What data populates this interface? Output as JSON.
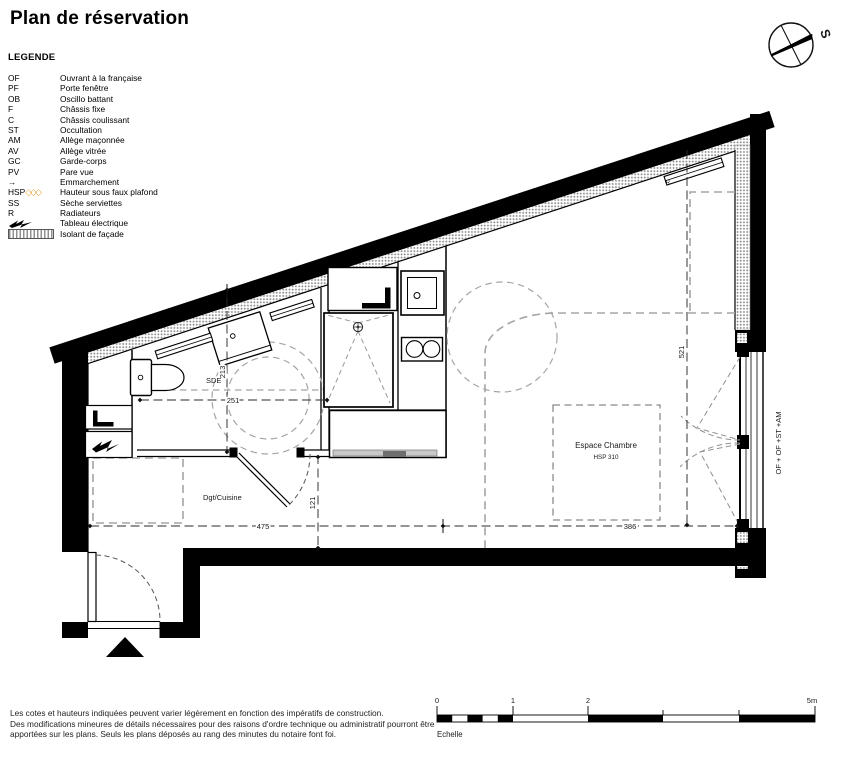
{
  "title": "Plan de réservation",
  "legend": {
    "heading": "LEGENDE",
    "hsp_diamonds": "◇◇◇",
    "items": [
      {
        "abbr": "OF",
        "label": "Ouvrant à la française"
      },
      {
        "abbr": "PF",
        "label": "Porte fenêtre"
      },
      {
        "abbr": "OB",
        "label": "Oscillo battant"
      },
      {
        "abbr": "F",
        "label": "Châssis fixe"
      },
      {
        "abbr": "C",
        "label": "Châssis coulissant"
      },
      {
        "abbr": "ST",
        "label": "Occultation"
      },
      {
        "abbr": "AM",
        "label": "Allège maçonnée"
      },
      {
        "abbr": "AV",
        "label": "Allège vitrée"
      },
      {
        "abbr": "GC",
        "label": "Garde-corps"
      },
      {
        "abbr": "PV",
        "label": "Pare vue"
      },
      {
        "abbr": "→",
        "label": "Emmarchement"
      },
      {
        "abbr": "HSP",
        "label": "Hauteur sous faux plafond"
      },
      {
        "abbr": "SS",
        "label": "Sèche serviettes"
      },
      {
        "abbr": "R",
        "label": "Radiateurs"
      },
      {
        "abbr": "",
        "label": "Tableau électrique"
      },
      {
        "abbr": "",
        "label": "Isolant de façade"
      }
    ]
  },
  "plan": {
    "labels": {
      "sde": "SDE",
      "dgt_cuisine": "Dgt/Cuisine",
      "chambre": "Espace Chambre",
      "chambre_hsp": "HSP 310",
      "radiator": "R",
      "window": "OF + OF +ST +AM"
    },
    "dimensions": {
      "bath_height": "213",
      "bath_width": "251",
      "room_height": "521",
      "passage": "121",
      "left_width": "475",
      "right_width": "386"
    }
  },
  "compass": {
    "south": "S"
  },
  "scale": {
    "ticks": [
      "0",
      "1",
      "2",
      "5m"
    ],
    "caption": "Echelle"
  },
  "footer": {
    "lines": [
      "Les cotes et hauteurs indiquées peuvent varier légèrement en fonction des impératifs de construction.",
      "Des modifications mineures de détails nécessaires pour des raisons d'ordre technique ou administratif pourront être",
      "apportées sur les plans. Seuls les plans déposés au rang des minutes du notaire font foi."
    ]
  },
  "colors": {
    "wall": "#000000",
    "insulation_dot": "#8f8f8f",
    "zone_dash": "#a5a5a5",
    "dimension": "#2b2b2b",
    "hsp_accent": "#e8a33d"
  }
}
